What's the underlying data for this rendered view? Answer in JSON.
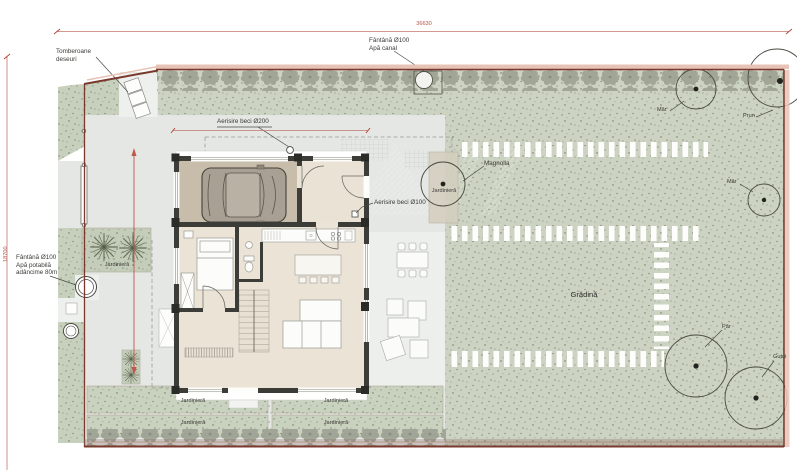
{
  "dimensions": {
    "top": "36630",
    "left": "18700"
  },
  "labels": {
    "tomberoane": [
      "Tomberoane",
      "deseuri"
    ],
    "fantana_canal": [
      "Fântână Ø100",
      "Apă canal"
    ],
    "fantana_potabila": [
      "Fântână Ø100",
      "Apă potabilă",
      "adâncime 80m"
    ],
    "aerisire_beci_200": "Aerisire beci Ø200",
    "aerisire_beci_100": "Aerisire beci Ø100",
    "gradina": "Grădină",
    "jardiniera": "Jardinieră"
  },
  "trees": {
    "magnolia": "Magnolia",
    "mar_top": "Măr",
    "prun": "Prun",
    "mar_right": "Măr",
    "par": "Păr",
    "gutui": "Gutui"
  },
  "colors": {
    "boundary": "#7a382c",
    "dimension_red": "#c0564c",
    "grass": "#ccd3c2",
    "paved": "#e4e7e3",
    "wall": "#3c3c38",
    "hedge": "#9da294",
    "garage_floor": "#c8bcab",
    "room_floor": "#ebe3d5"
  }
}
